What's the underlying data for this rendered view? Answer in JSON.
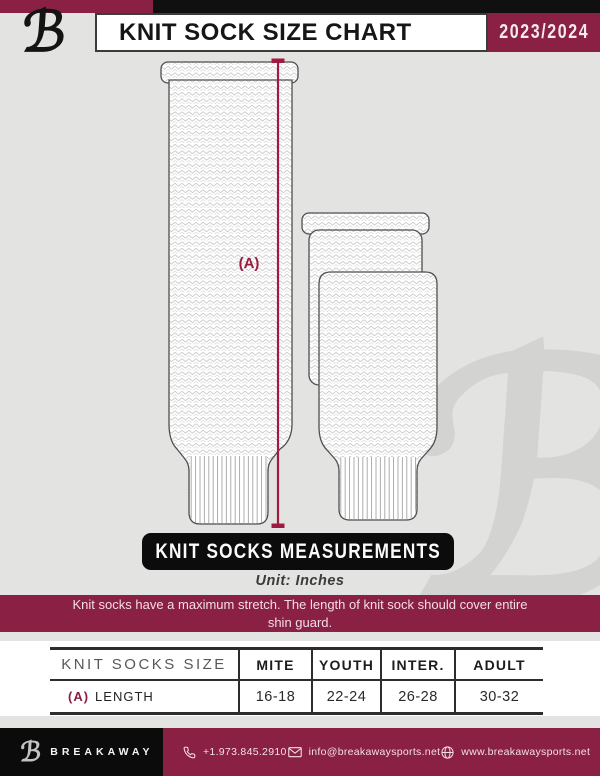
{
  "icons": {
    "logo_glyph": "ℬ"
  },
  "header": {
    "title": "KNIT SOCK SIZE CHART",
    "season": "2023/2024"
  },
  "diagram": {
    "measurement_label": "(A)"
  },
  "measurements": {
    "banner_title": "KNIT SOCKS MEASUREMENTS",
    "unit_label": "Unit: Inches",
    "note": "Knit socks have a maximum stretch. The length of knit sock should cover entire shin guard."
  },
  "table": {
    "header": [
      "KNIT SOCKS SIZE",
      "MITE",
      "YOUTH",
      "INTER.",
      "ADULT"
    ],
    "rows": [
      {
        "key": "(A)",
        "label": "LENGTH",
        "values": [
          "16-18",
          "22-24",
          "26-28",
          "30-32"
        ]
      }
    ]
  },
  "chart_data": {
    "type": "table",
    "title": "KNIT SOCK SIZE CHART",
    "unit": "Inches",
    "categories": [
      "MITE",
      "YOUTH",
      "INTER.",
      "ADULT"
    ],
    "series": [
      {
        "name": "(A) LENGTH",
        "values": [
          "16-18",
          "22-24",
          "26-28",
          "30-32"
        ]
      }
    ]
  },
  "footer": {
    "brand": "BREAKAWAY",
    "phone": "+1.973.845.2910",
    "email": "info@breakawaysports.net",
    "website": "www.breakawaysports.net"
  },
  "colors": {
    "maroon": "#8a2043",
    "measure_line": "#a01b41",
    "page_bg": "#e3e4e2",
    "banner_black": "#0c0c0c"
  }
}
